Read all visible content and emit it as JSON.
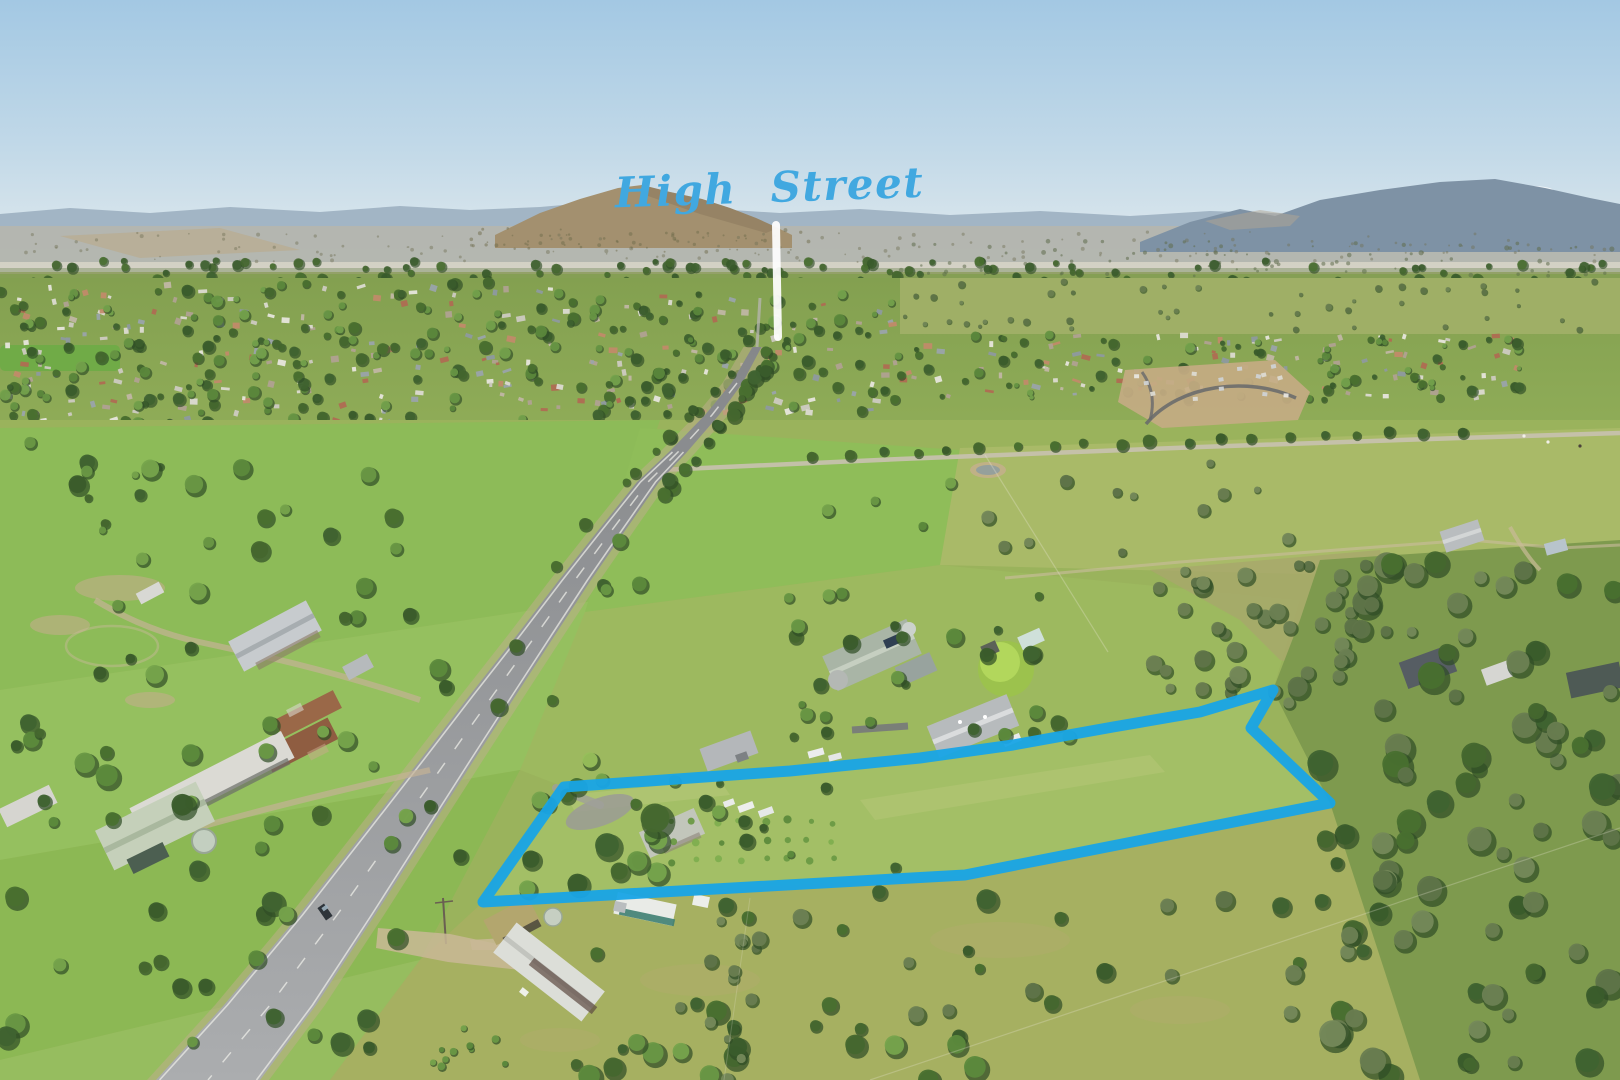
{
  "image": {
    "description": "Aerial drone photograph of a rural township and highway with a waterfront of green paddocks; a residential acreage property is outlined in blue in the foreground and the main street of the town is labelled with an arrow.",
    "width_px": 1620,
    "height_px": 1080
  },
  "overlay": {
    "street_label": {
      "text": "High Street",
      "color": "#41a8e0",
      "x": 770,
      "y": 202,
      "font_size": 42,
      "rotation_deg": -2
    },
    "street_arrow": {
      "color": "#ffffff",
      "opacity": 0.93,
      "x1": 776,
      "y1": 225,
      "x2": 778,
      "y2": 337,
      "stroke_width": 8
    },
    "property_boundary": {
      "color": "#18a4e6",
      "stroke_width": 11,
      "opacity": 0.95,
      "points": [
        [
          483,
          902
        ],
        [
          564,
          787
        ],
        [
          790,
          771
        ],
        [
          920,
          758
        ],
        [
          1013,
          745
        ],
        [
          1113,
          727
        ],
        [
          1200,
          712
        ],
        [
          1273,
          690
        ],
        [
          1251,
          728
        ],
        [
          1330,
          803
        ],
        [
          965,
          875
        ]
      ]
    }
  },
  "palette": {
    "annotation_blue": "#18a4e6",
    "label_blue": "#41a8e0",
    "arrow_white": "#ffffff",
    "sky_top": "#a3c8e3",
    "sky_horizon": "#e3ebee",
    "mountain_far": "#9db1c1",
    "mountain_right": "#7e92a5",
    "hill_brown": "#a3906f",
    "field_bright_green": "#8dbb58",
    "field_olive": "#a6b061",
    "road_grey": "#95979a"
  }
}
